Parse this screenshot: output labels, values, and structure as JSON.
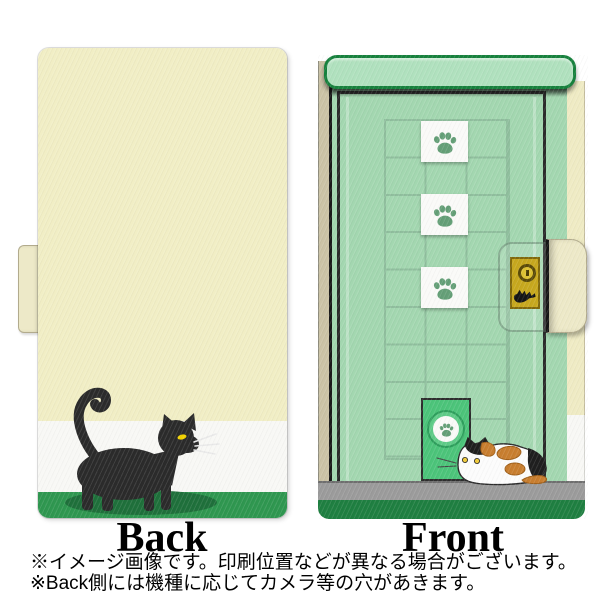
{
  "labels": {
    "back": "Back",
    "front": "Front"
  },
  "disclaimer": {
    "line1": "※イメージ画像です。印刷位置などが異なる場合がございます。",
    "line2": "※Back側には機種に応じてカメラ等の穴があきます。"
  },
  "front_case": {
    "tile_grid": {
      "columns": 3,
      "rows": 9
    },
    "paw_tile_count": 3,
    "icons": [
      "paw-print-icon",
      "keyhole-icon",
      "scratch-marks-icon"
    ]
  },
  "back_case": {
    "illustration": "black cat walking right with raised tail",
    "bands": [
      "cream",
      "white",
      "green"
    ]
  },
  "colors": {
    "page_bg": "#ffffff",
    "back_cream": "#F1EEC5",
    "white_band": "#F8F8F5",
    "back_green": "#2F9750",
    "cat_black": "#2B2B2B",
    "cat_eye_yellow": "#F2D200",
    "whisker_gray": "#E9E9E9",
    "cat_shadow_green": "#1E6B38",
    "strap_cream": "#EDE9C8",
    "strap_border": "#B2AB8D",
    "mint": "#A3D7B0",
    "mint_light": "#B0E1BE",
    "top_bar_border": "#17813D",
    "frame_dark": "#2B2B2B",
    "grid_line": "#8FBE9D",
    "tile_white": "#FAFAF8",
    "paw_green": "#649F77",
    "door_green": "#4CC47A",
    "door_ring_dark": "#2E9E5C",
    "door_ring_light": "#5ECB87",
    "gold": "#C7A81E",
    "gold_dark": "#81690B",
    "keyhole_gold": "#DCC133",
    "floor_gray": "#9B9B9B",
    "floor_edge": "#6F6F6F",
    "front_bottom_green": "#1F7F41",
    "edge_tan": "#CBC3A6",
    "spine_cream": "#EFEBC4",
    "calico_orange": "#C87E2F",
    "calico_orange_dark": "#9E5E18",
    "calico_black": "#1F1F1F",
    "calico_eye": "#EFC937"
  }
}
